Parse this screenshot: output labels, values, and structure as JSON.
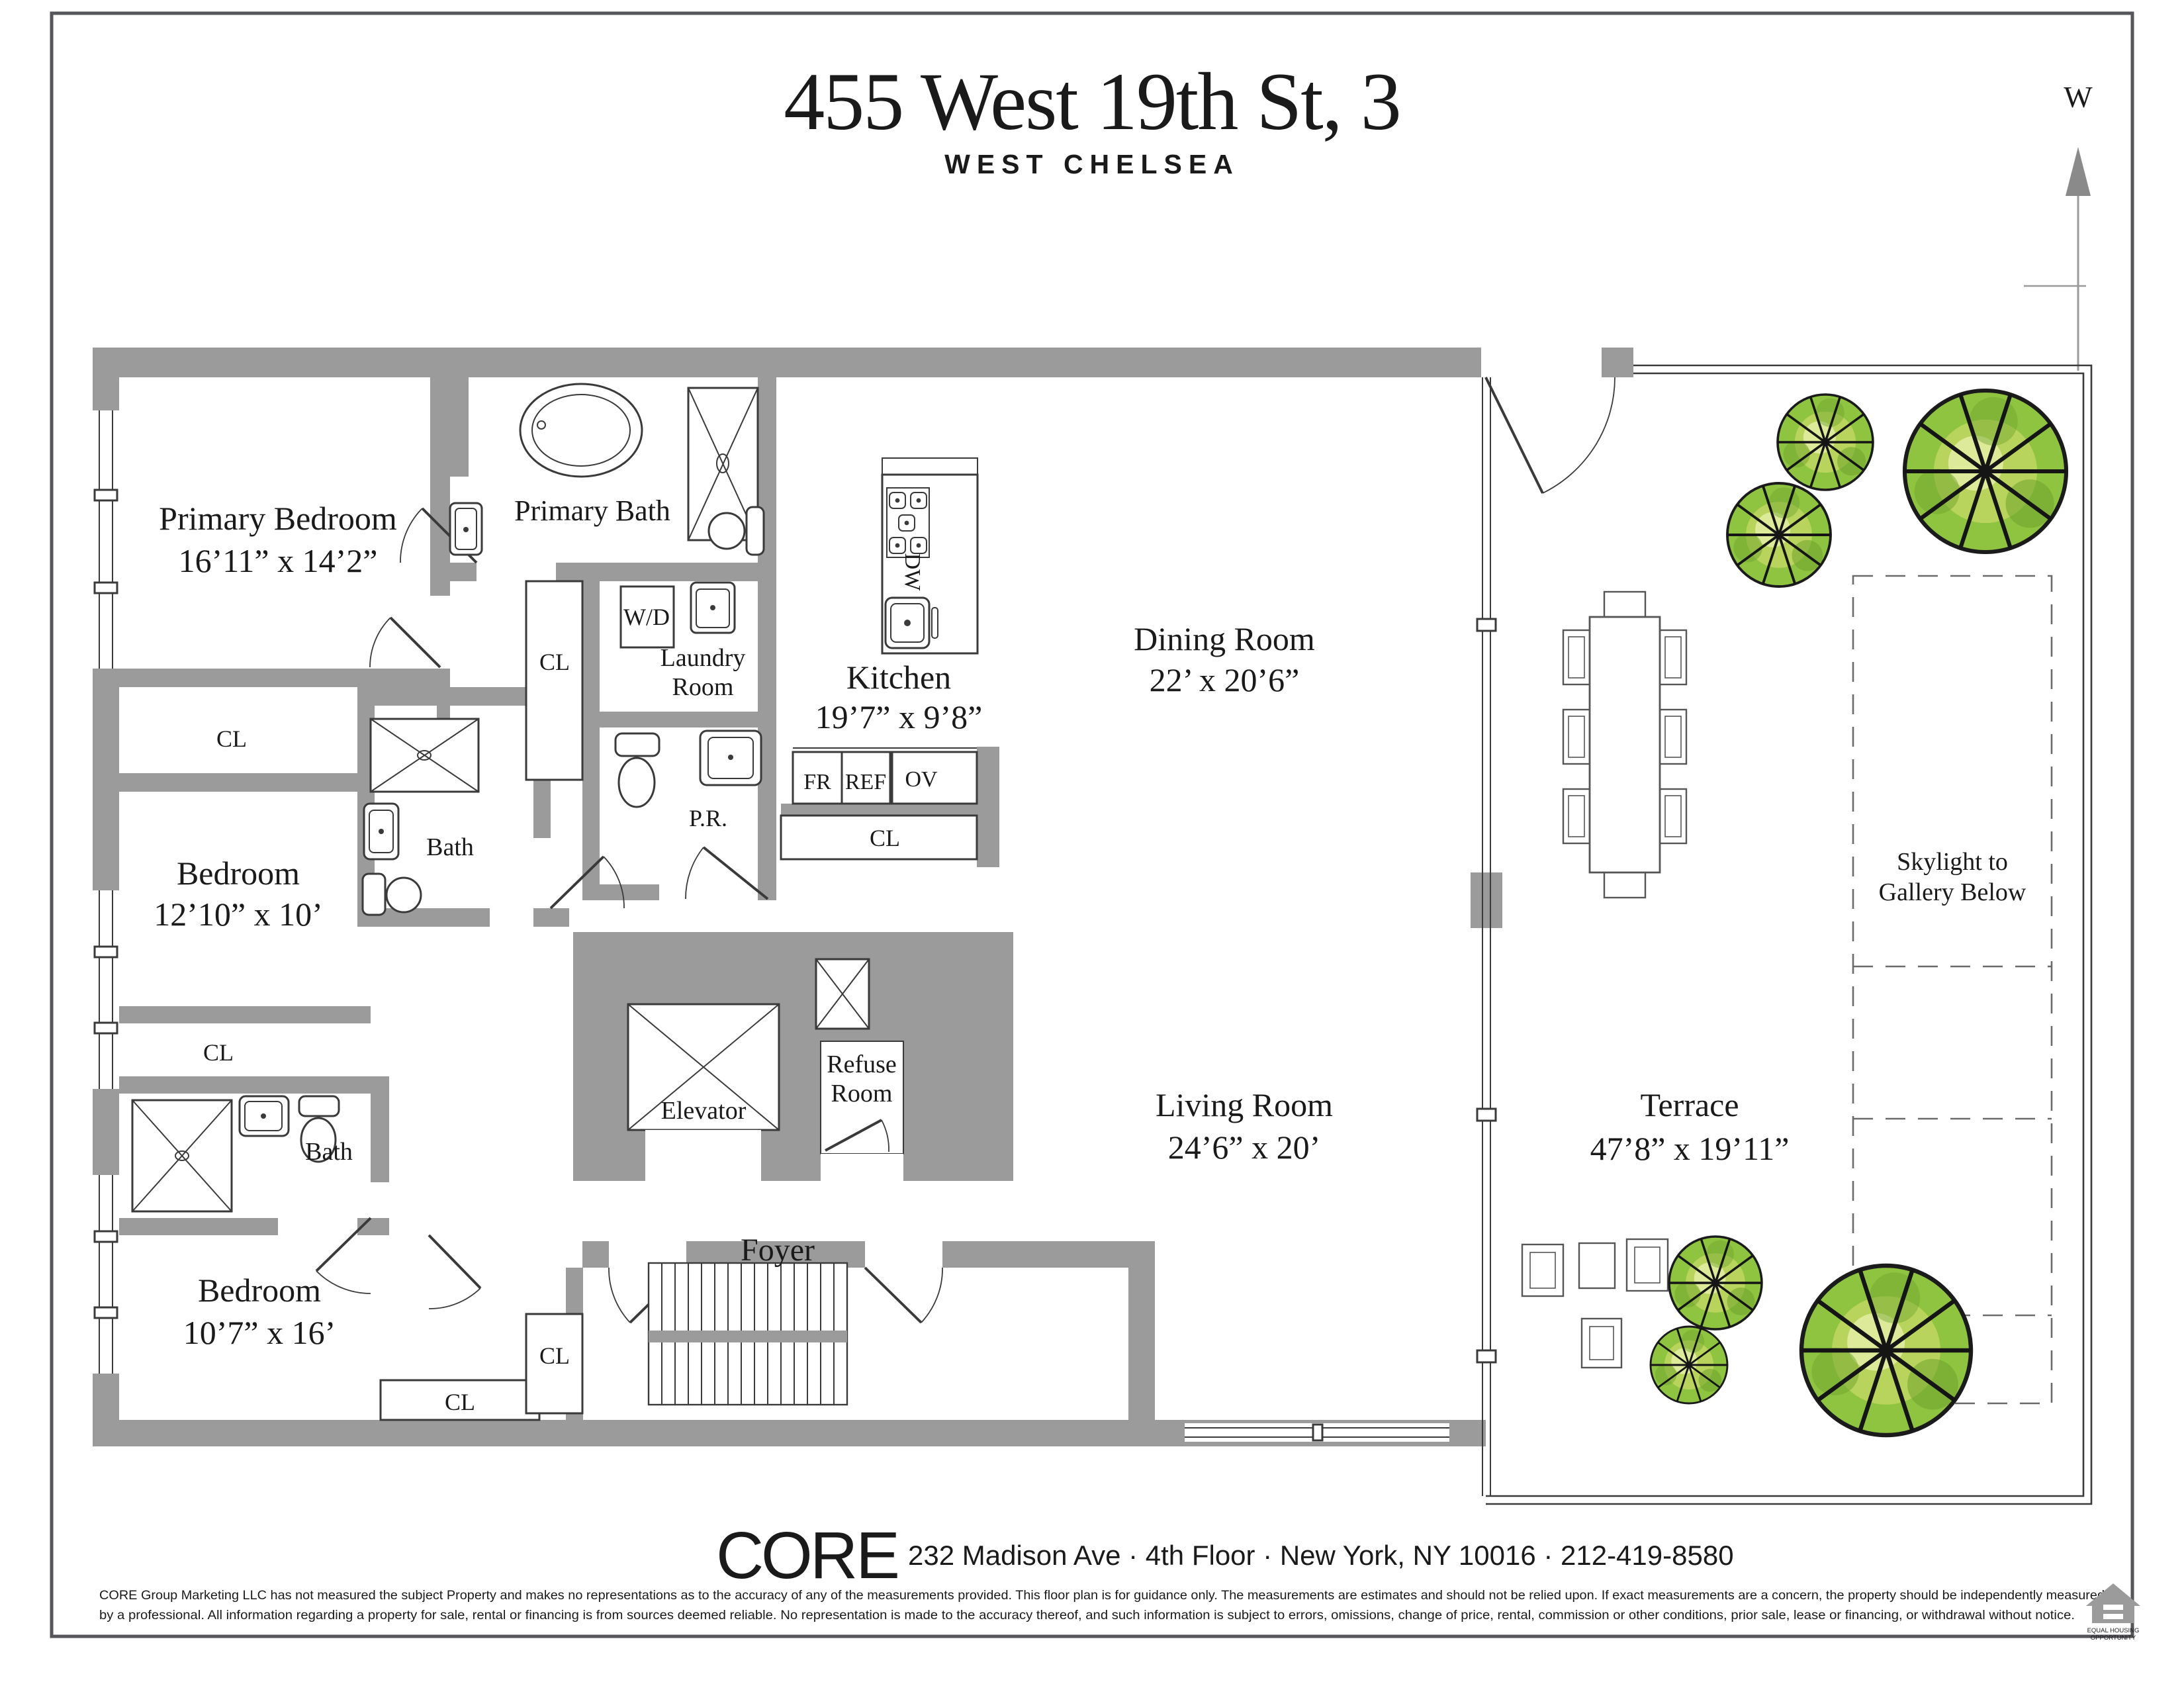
{
  "page": {
    "title": "455 West 19th St, 3",
    "subtitle": "WEST CHELSEA"
  },
  "compass": {
    "label": "W",
    "color": "#E1251B"
  },
  "rooms": {
    "primary_bedroom": {
      "label": "Primary Bedroom",
      "dims": "16’11” x 14’2”"
    },
    "primary_bath": {
      "label": "Primary Bath"
    },
    "laundry": {
      "line1": "Laundry",
      "line2": "Room"
    },
    "wd": {
      "label": "W/D"
    },
    "pr": {
      "label": "P.R."
    },
    "kitchen": {
      "label": "Kitchen",
      "dims": "19’7” x 9’8”"
    },
    "dining": {
      "label": "Dining Room",
      "dims": "22’ x 20’6”"
    },
    "living": {
      "label": "Living Room",
      "dims": "24’6” x 20’"
    },
    "terrace": {
      "label": "Terrace",
      "dims": "47’8” x 19’11”"
    },
    "bedroom_2": {
      "label": "Bedroom",
      "dims": "12’10” x 10’"
    },
    "bedroom_3": {
      "label": "Bedroom",
      "dims": "10’7” x 16’"
    },
    "bath": {
      "label": "Bath"
    },
    "foyer": {
      "label": "Foyer"
    },
    "elevator": {
      "label": "Elevator"
    },
    "refuse": {
      "line1": "Refuse",
      "line2": "Room"
    },
    "skylight": {
      "line1": "Skylight to",
      "line2": "Gallery Below"
    },
    "closet": "CL"
  },
  "appliances": {
    "fr": "FR",
    "ref": "REF",
    "ov": "OV",
    "dw": "DW"
  },
  "footer": {
    "brand_c": "C",
    "brand_o": "O",
    "brand_re": "RE",
    "brand_gray": "#97999B",
    "brand_red": "#EA3425",
    "address": "232 Madison Ave · 4th Floor · New York, NY 10016 · 212-419-8580",
    "disclaimer_line1": "CORE Group Marketing LLC has not measured the subject Property and makes no representations as to the accuracy of any of the measurements provided. This floor plan is for guidance only. The measurements are estimates and should not be relied upon. If exact measurements are a concern, the property should be independently measured",
    "disclaimer_line2": "by a professional. All information regarding a property for sale, rental or financing is from sources deemed reliable.  No representation is made to the accuracy thereof, and such information is subject to errors, omissions, change of price, rental, commission or other conditions, prior sale, lease or financing, or withdrawal without notice.",
    "equal_housing_line1": "EQUAL HOUSING",
    "equal_housing_line2": "OPPORTUNITY"
  }
}
